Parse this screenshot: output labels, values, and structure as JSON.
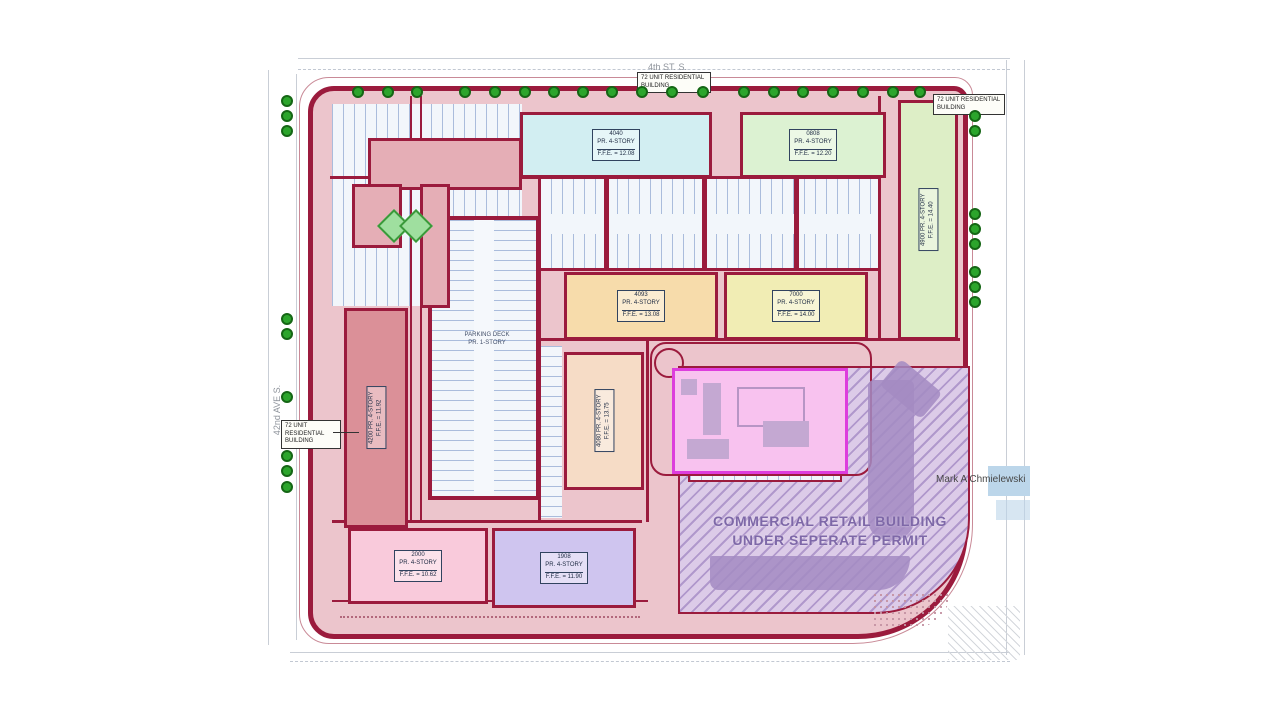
{
  "title": "Residential development site plan",
  "streets": {
    "top": "4th ST. S.",
    "left": "42nd AVE S."
  },
  "watermark": "Mark A Chmielewski",
  "notes": {
    "residential_top": "72 UNIT RESIDENTIAL BUILDING",
    "residential_right": "72 UNIT RESIDENTIAL BUILDING",
    "residential_left": "72 UNIT RESIDENTIAL BUILDING"
  },
  "commercial": {
    "line1": "COMMERCIAL RETAIL BUILDING",
    "line2": "UNDER SEPERATE PERMIT"
  },
  "parking_deck": {
    "line1": "PARKING DECK",
    "line2": "PR. 1-STORY"
  },
  "buildings": [
    {
      "id": "blue-top",
      "number": "4040",
      "story": "PR. 4-STORY",
      "ffe": "F.F.E. = 12.08",
      "color": "#d2eef2"
    },
    {
      "id": "green-top",
      "number": "0808",
      "story": "PR. 4-STORY",
      "ffe": "F.F.E. = 12.20",
      "color": "#dcf2d2"
    },
    {
      "id": "green-right",
      "number": "4900",
      "story": "PR. 4-STORY",
      "ffe": "F.F.E. = 14.40",
      "color": "#ddeec6"
    },
    {
      "id": "orange-mid",
      "number": "4093",
      "story": "PR. 4-STORY",
      "ffe": "F.F.E. = 13.08",
      "color": "#f7dcab"
    },
    {
      "id": "yellow-mid",
      "number": "7000",
      "story": "PR. 4-STORY",
      "ffe": "F.F.E. = 14.00",
      "color": "#f1edb4"
    },
    {
      "id": "red-left",
      "number": "4200",
      "story": "PR. 4-STORY",
      "ffe": "F.F.E. = 11.92",
      "color": "#db9098"
    },
    {
      "id": "tan-center",
      "number": "4080",
      "story": "PR. 4-STORY",
      "ffe": "F.F.E. = 13.75",
      "color": "#f6dcc6"
    },
    {
      "id": "pink-bottom",
      "number": "2000",
      "story": "PR. 4-STORY",
      "ffe": "F.F.E. = 10.62",
      "color": "#f9cadb"
    },
    {
      "id": "purple-bottom",
      "number": "1908",
      "story": "PR. 4-STORY",
      "ffe": "F.F.E. = 11.90",
      "color": "#cfc5ef"
    }
  ],
  "colors": {
    "site_fill": "#ecc5cc",
    "boundary": "#9b1b3d",
    "magenta_building": "#f8c2ef",
    "magenta_border": "#dd3ddd",
    "commercial_hatch": "#a38bc2",
    "commercial_text": "#7e68a8",
    "tree": "#2ca52c",
    "parking_stripe": "#6e8cc3"
  },
  "trees": {
    "top_y": 86,
    "top_xs": [
      352,
      382,
      411,
      459,
      489,
      519,
      548,
      577,
      606,
      636,
      666,
      697,
      738,
      768,
      797,
      827,
      857,
      887,
      914
    ],
    "left_x": 281,
    "left_ys": [
      95,
      110,
      125,
      313,
      328,
      391,
      450,
      465,
      481
    ],
    "right_x": 969,
    "right_ys": [
      110,
      125,
      208,
      223,
      238,
      266,
      281,
      296
    ]
  }
}
